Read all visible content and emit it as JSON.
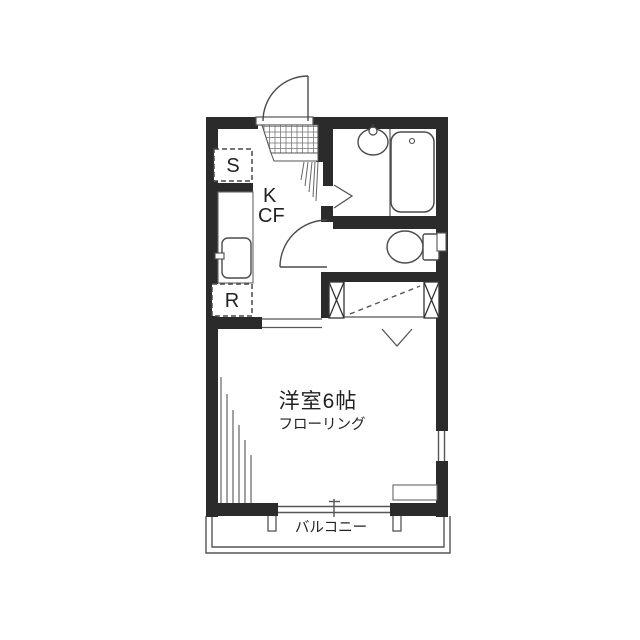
{
  "floorplan": {
    "type": "apartment-floor-plan-1K",
    "labels": {
      "shoe_storage": "S",
      "kitchen": "K",
      "kitchen_floor": "CF",
      "refrigerator": "R",
      "main_room": "洋室6帖",
      "main_room_flooring": "フローリング",
      "balcony": "バルコニー"
    },
    "colors": {
      "wall": "#2b2b2b",
      "line": "#555555",
      "fixture_line": "#444444",
      "text": "#222222",
      "background": "#ffffff"
    }
  }
}
